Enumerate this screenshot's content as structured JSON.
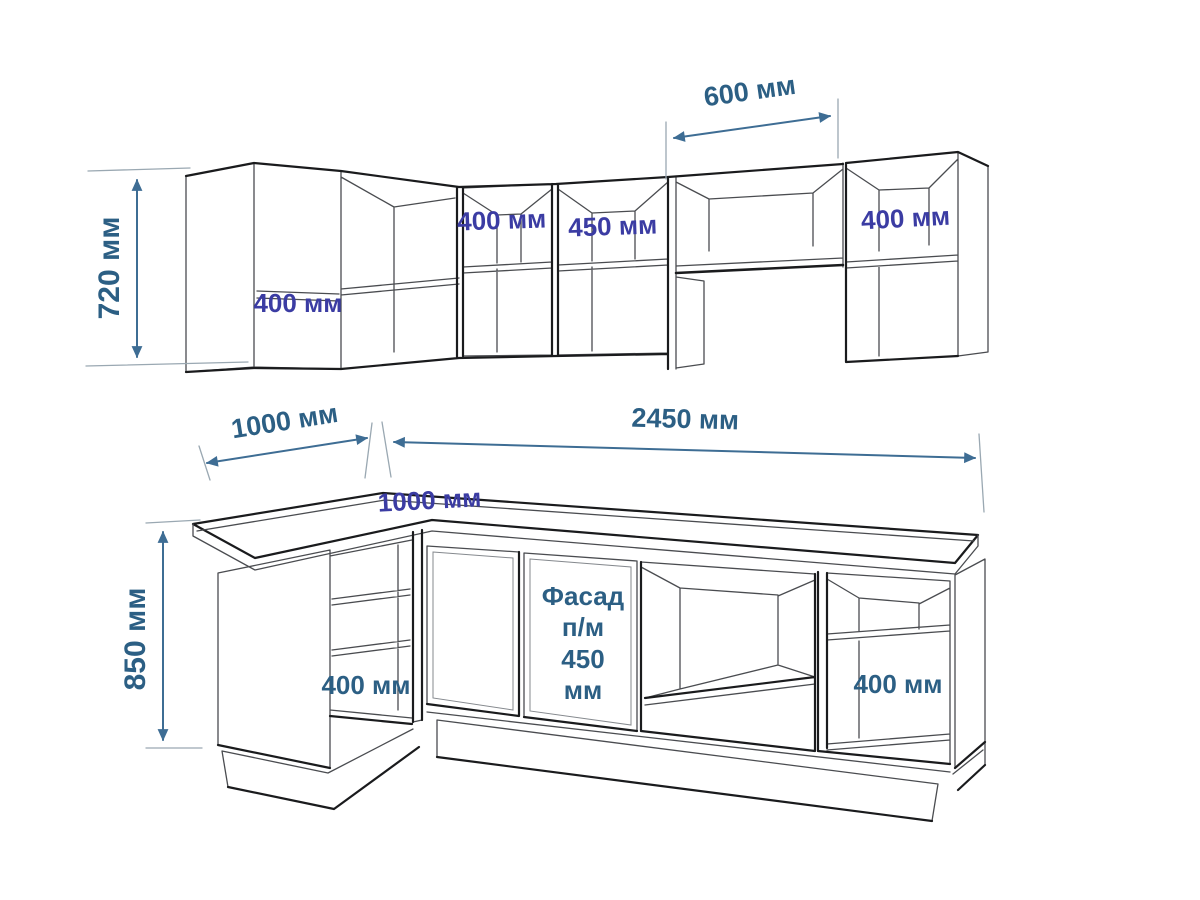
{
  "title": "Kitchen cabinets dimension drawing",
  "colors": {
    "background": "#ffffff",
    "dimension_lines": "#3e6d94",
    "dimension_text": "#2c5f84",
    "cabinet_label_text": "#3b3ca3",
    "drawing_line": "#4a4c50",
    "drawing_line_dark": "#1a1b1d"
  },
  "upper_section": {
    "height_dim": "720 мм",
    "hood_width_dim": "600 мм",
    "corner_cabinet_label": "400 мм",
    "cabinet_1_label": "400 мм",
    "cabinet_2_label": "450 мм",
    "right_cabinet_label": "400 мм"
  },
  "layout_dims": {
    "left_run": "1000 мм",
    "main_run": "2450 мм",
    "corner_depth": "1000 мм"
  },
  "base_section": {
    "height_dim": "850 мм",
    "corner_shelf_label": "400 мм",
    "facade": {
      "l1": "Фасад",
      "l2": "п/м",
      "l3": "450",
      "l4": "мм"
    },
    "right_shelf_label": "400 мм"
  }
}
